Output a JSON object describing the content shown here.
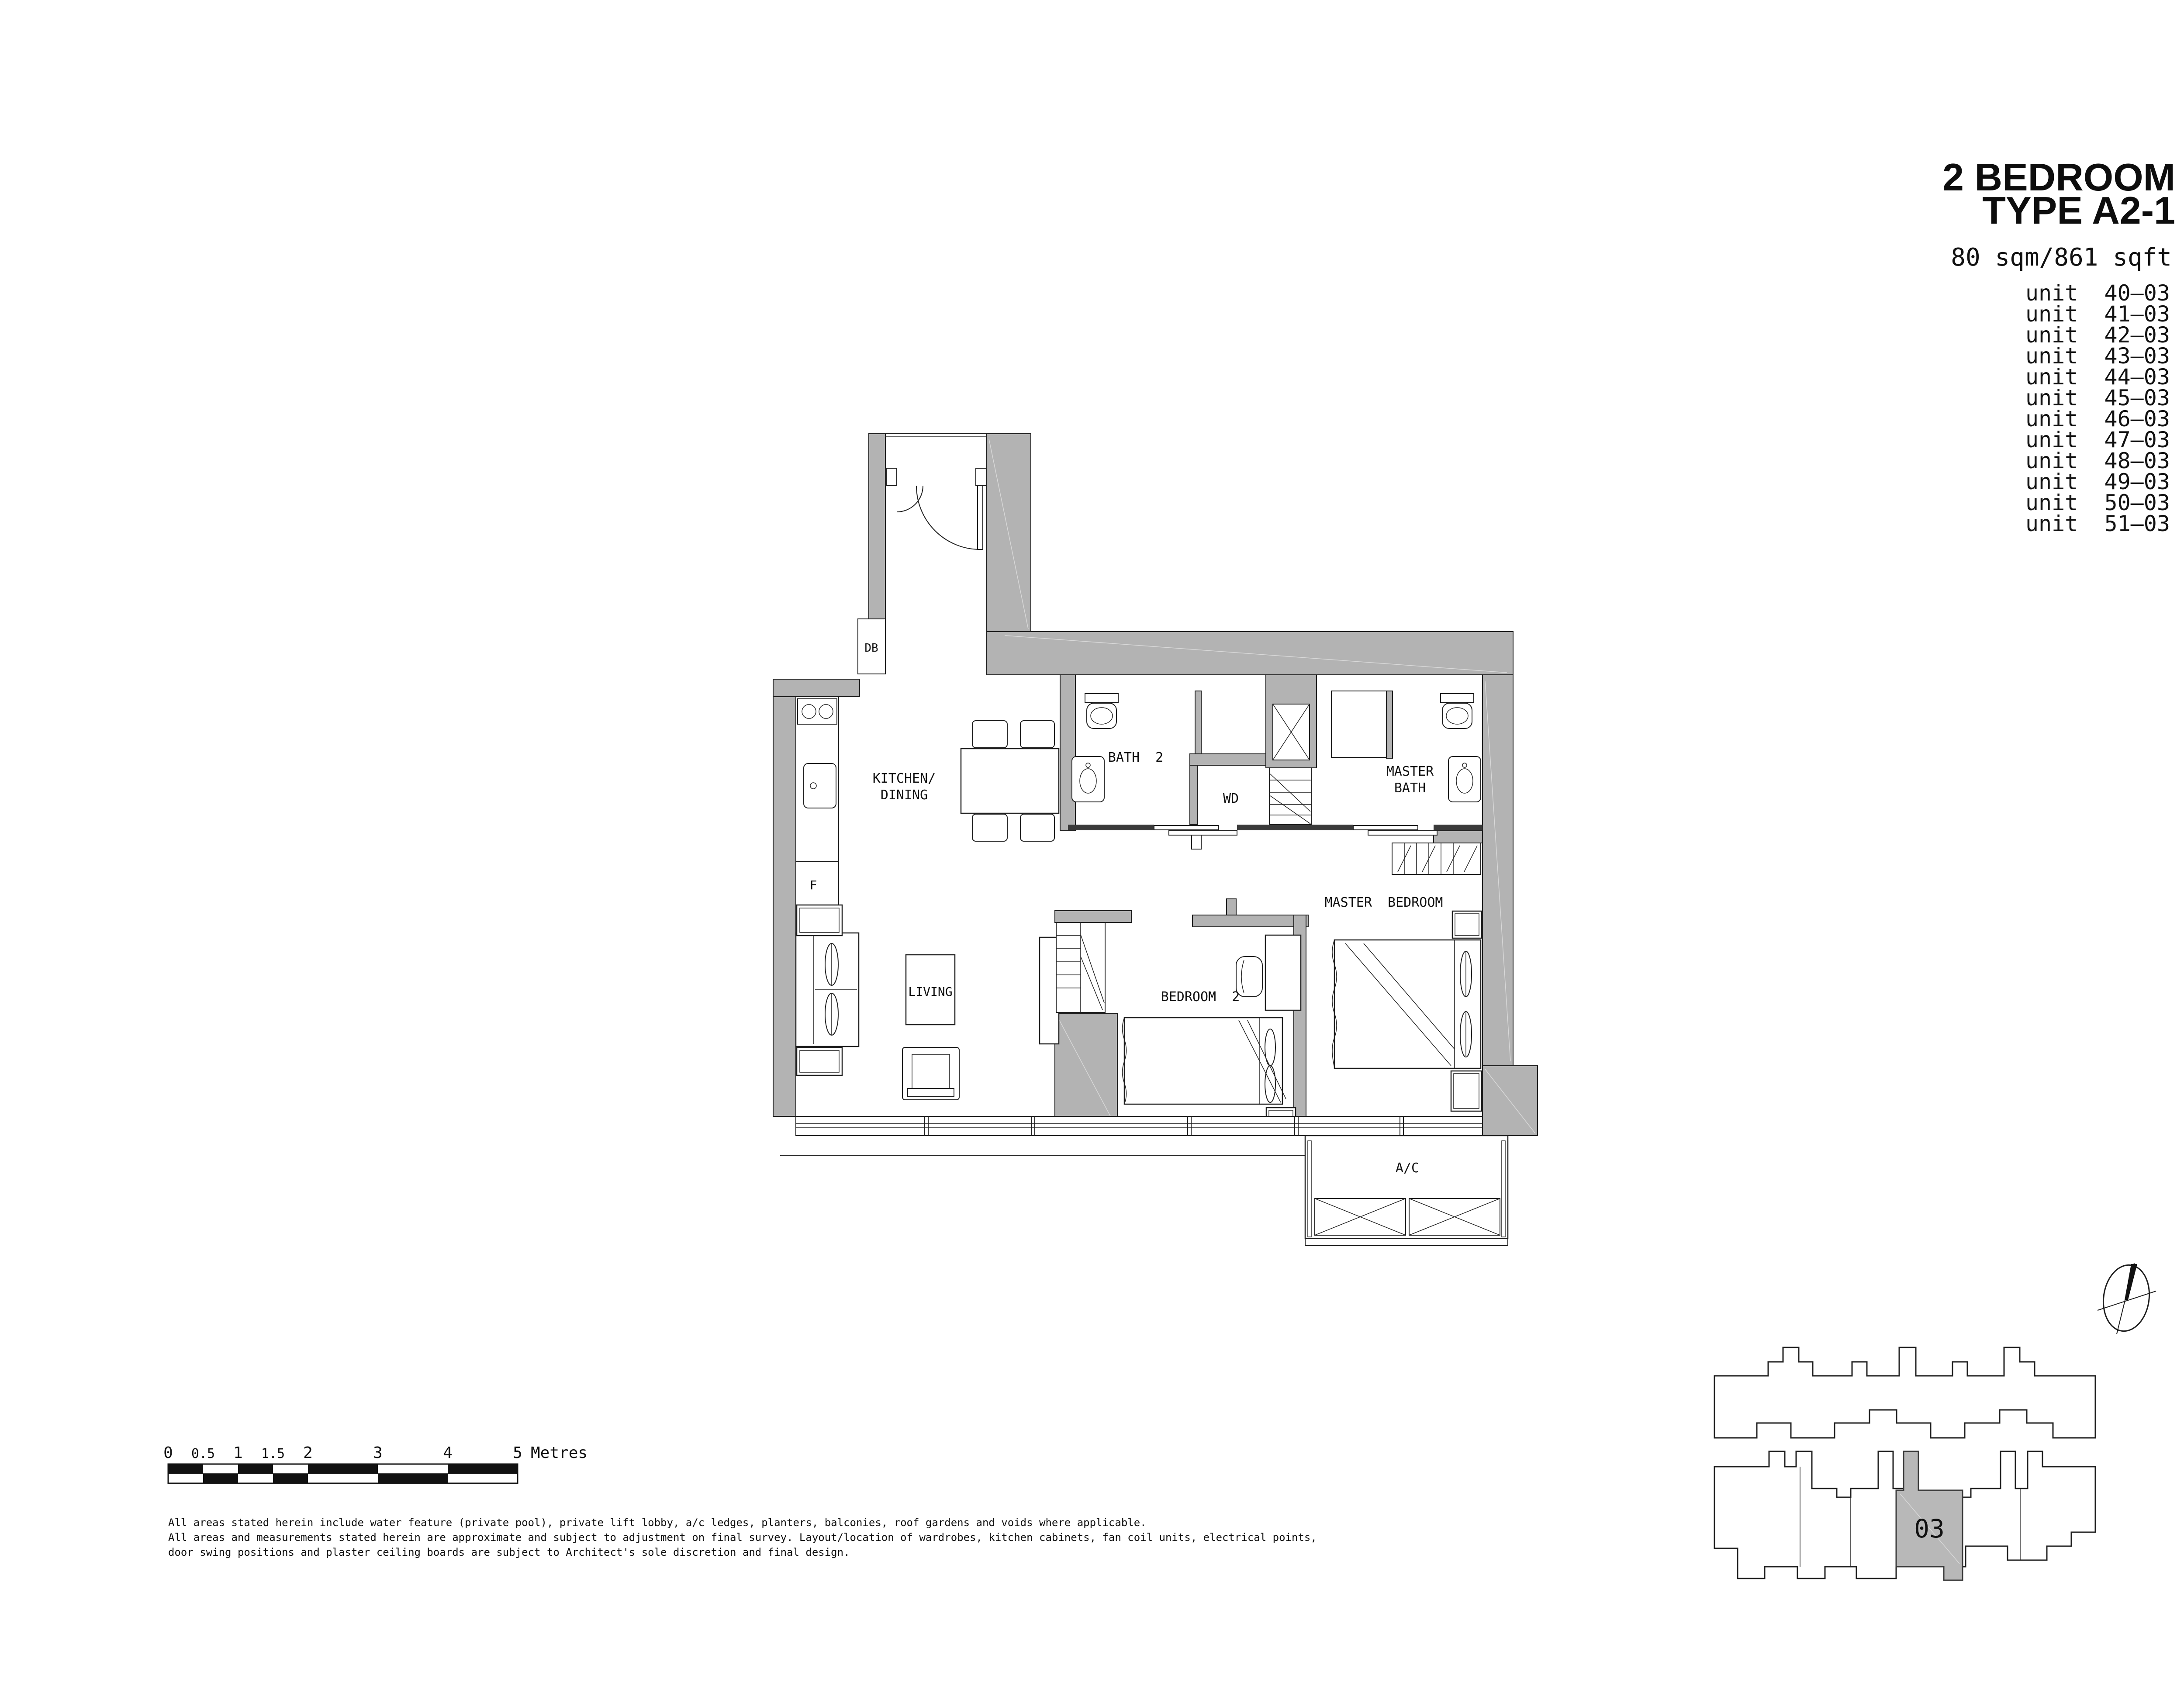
{
  "title": {
    "line1": "2 BEDROOM",
    "line2": "TYPE A2-1"
  },
  "area_label": "80 sqm/861 sqft",
  "unit_list": [
    "unit  40–03",
    "unit  41–03",
    "unit  42–03",
    "unit  43–03",
    "unit  44–03",
    "unit  45–03",
    "unit  46–03",
    "unit  47–03",
    "unit  48–03",
    "unit  49–03",
    "unit  50–03",
    "unit  51–03"
  ],
  "rooms": {
    "db": "DB",
    "kitchen_line1": "KITCHEN/",
    "kitchen_line2": "DINING",
    "fridge": "F",
    "bath2": "BATH  2",
    "wd": "WD",
    "master_bath_line1": "MASTER",
    "master_bath_line2": "BATH",
    "master_bedroom": "MASTER  BEDROOM",
    "bedroom2": "BEDROOM  2",
    "living": "LIVING",
    "ac_ledge": "A/C"
  },
  "key_plan": {
    "highlighted_unit": "03"
  },
  "scale_bar": {
    "ticks": [
      "0",
      "0.5",
      "1",
      "1.5",
      "2",
      "3",
      "4",
      "5"
    ],
    "unit_label": "Metres"
  },
  "disclaimer": {
    "line1": "All areas stated herein include water feature (private pool), private lift lobby, a/c ledges, planters, balconies, roof gardens and voids where applicable.",
    "line2": "All areas and measurements stated herein are approximate and subject to adjustment on final survey. Layout/location of wardrobes, kitchen cabinets, fan coil units, electrical points,",
    "line3": "door swing positions and plaster ceiling boards are subject to Architect's sole discretion and final design."
  },
  "colors": {
    "wall": "#b3b3b3",
    "line": "#1f1f1f",
    "unit_highlight": "#b8b8b8"
  }
}
